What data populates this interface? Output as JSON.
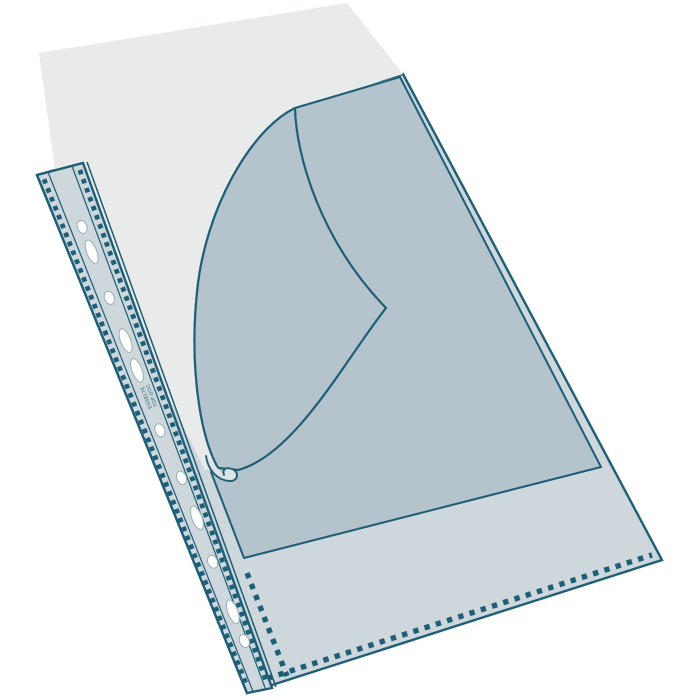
{
  "meta": {
    "description": "Product illustration of a transparent punched pocket (sheet protector) with a multipunch filing strip, shown with the front film peeled back in a curve and a blank paper sheet protruding from the open top edge",
    "background": "#ffffff"
  },
  "illustration": {
    "parts": {
      "paper_sheet": "blank paper sheet inside pocket",
      "pocket_body": "transparent pocket body",
      "opening": "revealed pocket interior",
      "flap": "front film folded back",
      "curl": "curled tip of folded film",
      "strip": "multipunch filing strip",
      "weld_seam": "serrated weld seam",
      "holes_count": 11
    },
    "strip_text": {
      "line1": "TOP DOC",
      "line2": "ESSELTE"
    },
    "colors": {
      "outline": "#1E5E76",
      "body": "#CDD7DC",
      "inside": "#B5C3CC",
      "paper": "#E9EAEA",
      "curl": "#DCE2E6",
      "hole": "#FFFFFF"
    }
  }
}
